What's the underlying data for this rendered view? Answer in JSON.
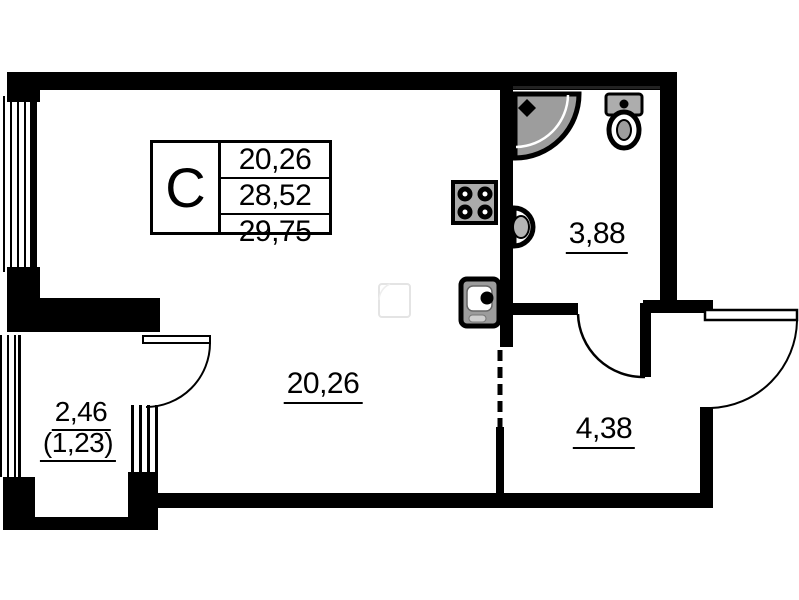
{
  "plan": {
    "type": "apartment-floor-plan",
    "colors": {
      "background": "#ffffff",
      "wall": "#000000",
      "fixture_fill": "#a2a2a2"
    },
    "legend": {
      "type_label": "C",
      "values": [
        "20,26",
        "28,52",
        "29,75"
      ]
    },
    "rooms": {
      "living": {
        "area": "20,26"
      },
      "bathroom": {
        "area": "3,88"
      },
      "hall": {
        "area": "4,38"
      },
      "balcony": {
        "area": "2,46",
        "area_secondary": "(1,23)"
      }
    },
    "icons": {
      "shower": "shower-icon",
      "toilet": "toilet-icon",
      "bathroom_sink": "sink-icon",
      "stove": "stove-icon",
      "kitchen_sink": "kitchen-sink-icon"
    }
  }
}
